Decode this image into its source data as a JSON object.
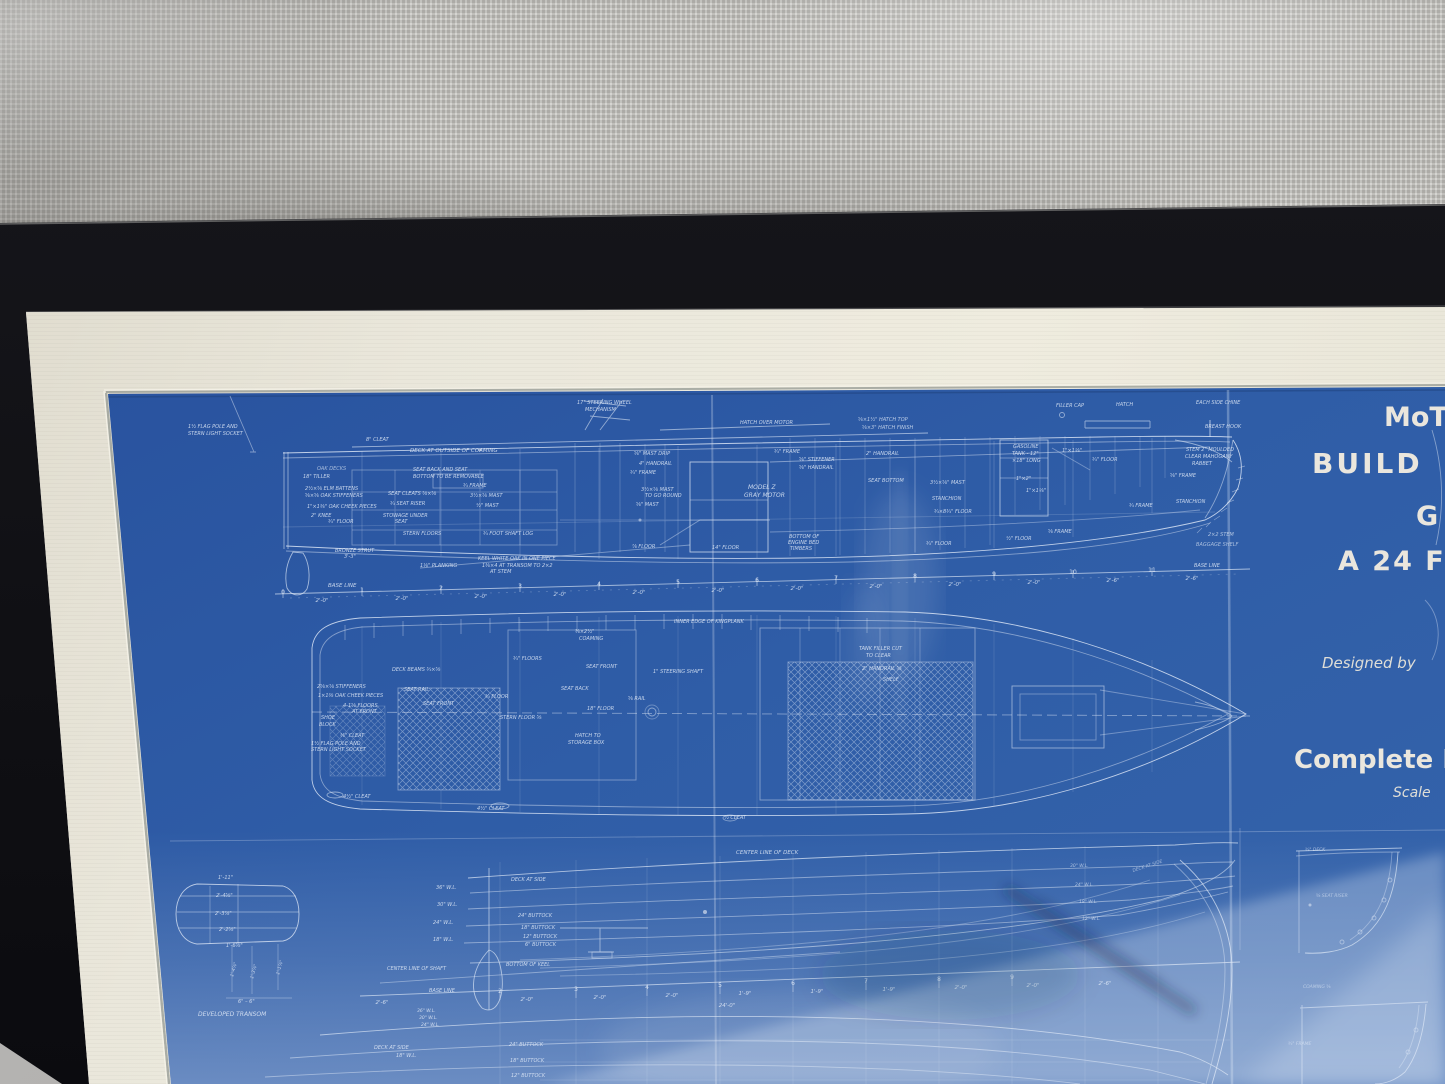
{
  "scene": {
    "description": "Photograph of a framed vintage motor-boat blueprint (white lines on blue paper) in a black frame with cream mat, hung against gray woven fabric; glass reflections across lower half",
    "views": [
      "profile construction elevation",
      "deck plan",
      "lines drawing with developed transom and sections"
    ]
  },
  "colors": {
    "fabric_gray": "#c7c6c2",
    "frame_black": "#141419",
    "mat_cream": "#eae7db",
    "wall_gray": "#b3b2b0",
    "blueprint_blue": "#2f5da6",
    "blueprint_blue_dark": "#27509a",
    "line_ink": "#d9e4f4",
    "title_ink": "#f0ebdf",
    "reflection_tint": "#dde6f5",
    "shadow_tint": "#1a2746"
  },
  "annotations": [
    {
      "n": "title-line-1",
      "t": "MoT",
      "x": 1384,
      "y": 426,
      "s": 27,
      "w": 1,
      "u": 1,
      "c": "#f0ebdf",
      "o": 0.97
    },
    {
      "n": "title-line-2",
      "t": "BUILD",
      "x": 1312,
      "y": 473,
      "s": 28,
      "w": 1,
      "u": 1,
      "c": "#f0ebdf",
      "o": 0.97,
      "ls": 3
    },
    {
      "n": "title-line-3",
      "t": "G",
      "x": 1416,
      "y": 525,
      "s": 27,
      "w": 1,
      "u": 1,
      "c": "#f0ebdf",
      "o": 0.97
    },
    {
      "n": "title-line-4",
      "t": "A 24 F",
      "x": 1338,
      "y": 570,
      "s": 27,
      "w": 1,
      "u": 1,
      "c": "#f0ebdf",
      "o": 0.97,
      "ls": 2
    },
    {
      "n": "designed-by",
      "t": "Designed  by",
      "x": 1322,
      "y": 668,
      "s": 15,
      "c": "#e9e5da",
      "o": 0.95
    },
    {
      "n": "complete-label",
      "t": "Complete H",
      "x": 1294,
      "y": 768,
      "s": 26,
      "w": 1,
      "u": 1,
      "c": "#f0ebdf",
      "o": 0.97
    },
    {
      "n": "scale-label",
      "t": "Scale",
      "x": 1393,
      "y": 797,
      "s": 14,
      "c": "#e9e5da",
      "o": 0.95
    },
    {
      "t": "8\" CLEAT",
      "x": 366,
      "y": 441
    },
    {
      "t": "DECK AT OUTSIDE OF COAMING",
      "x": 410,
      "y": 452,
      "s": 5.5
    },
    {
      "t": "SEAT BACK AND SEAT",
      "x": 413,
      "y": 471
    },
    {
      "t": "BOTTOM TO BE REMOVABLE",
      "x": 413,
      "y": 478
    },
    {
      "t": "17\" STEERING WHEEL",
      "x": 577,
      "y": 404
    },
    {
      "t": "MECHANISM",
      "x": 585,
      "y": 411
    },
    {
      "t": "1½ FLAG POLE AND",
      "x": 188,
      "y": 428
    },
    {
      "t": "STERN LIGHT SOCKET",
      "x": 188,
      "y": 435
    },
    {
      "t": "OAK DECKS",
      "x": 317,
      "y": 470,
      "o": 0.7
    },
    {
      "t": "18\" TILLER",
      "x": 303,
      "y": 478
    },
    {
      "t": "2½×⅝ ELM BATTENS",
      "x": 305,
      "y": 490
    },
    {
      "t": "⅝×⅝ OAK STIFFENERS",
      "x": 305,
      "y": 497
    },
    {
      "t": "1\"×1⅜\" OAK CHEEK PIECES",
      "x": 307,
      "y": 508
    },
    {
      "t": "2\" KNEE",
      "x": 311,
      "y": 517
    },
    {
      "t": "¾\" FLOOR",
      "x": 328,
      "y": 523
    },
    {
      "t": "BRONZE STRUT",
      "x": 335,
      "y": 552
    },
    {
      "t": "3'-3\"",
      "x": 344,
      "y": 558
    },
    {
      "t": "SEAT CLEATS ⅝×⅝",
      "x": 388,
      "y": 495
    },
    {
      "t": "¾ SEAT RISER",
      "x": 390,
      "y": 505
    },
    {
      "t": "STOWAGE UNDER",
      "x": 383,
      "y": 517
    },
    {
      "t": "SEAT",
      "x": 395,
      "y": 523
    },
    {
      "t": "¾ FRAME",
      "x": 463,
      "y": 487
    },
    {
      "t": "3½×⅝ MAST",
      "x": 470,
      "y": 497
    },
    {
      "t": "½\" MAST",
      "x": 476,
      "y": 507
    },
    {
      "t": "STERN FLOORS",
      "x": 403,
      "y": 535
    },
    {
      "t": "¾ FOOT SHAFT LOG",
      "x": 483,
      "y": 535
    },
    {
      "t": "1⅛\" PLANKING",
      "x": 420,
      "y": 567
    },
    {
      "t": "KEEL WHITE OAK IN ONE PIECE",
      "x": 478,
      "y": 560
    },
    {
      "t": "1⅜×4 AT TRANSOM TO 2×2",
      "x": 482,
      "y": 567
    },
    {
      "t": "AT STEM",
      "x": 490,
      "y": 573
    },
    {
      "t": "BASE LINE",
      "x": 328,
      "y": 587,
      "s": 5.5
    },
    {
      "t": "⅝\" MAST DRIP",
      "x": 634,
      "y": 455
    },
    {
      "t": "4\" HANDRAIL",
      "x": 639,
      "y": 465
    },
    {
      "t": "¾\" FRAME",
      "x": 630,
      "y": 474
    },
    {
      "t": "3½×⅝ MAST",
      "x": 641,
      "y": 491
    },
    {
      "t": "TO GO ROUND",
      "x": 645,
      "y": 497
    },
    {
      "t": "⅝\" MAST",
      "x": 636,
      "y": 506
    },
    {
      "t": "MODEL Z",
      "x": 748,
      "y": 489,
      "s": 6
    },
    {
      "t": "GRAY MOTOR",
      "x": 744,
      "y": 497,
      "s": 6
    },
    {
      "t": "HATCH OVER MOTOR",
      "x": 740,
      "y": 424
    },
    {
      "t": "⅝×1½\" HATCH TOP",
      "x": 858,
      "y": 421,
      "o": 0.8
    },
    {
      "t": "⅝×3\" HATCH FINISH",
      "x": 862,
      "y": 429,
      "o": 0.8
    },
    {
      "t": "¾\" FRAME",
      "x": 774,
      "y": 453
    },
    {
      "t": "⅝\" STIFFENER",
      "x": 799,
      "y": 461
    },
    {
      "t": "⅝\" HANDRAIL",
      "x": 799,
      "y": 469
    },
    {
      "t": "2\" HANDRAIL",
      "x": 866,
      "y": 455
    },
    {
      "t": "BOTTOM OF",
      "x": 789,
      "y": 538
    },
    {
      "t": "ENGINE BED",
      "x": 788,
      "y": 544
    },
    {
      "t": "TIMBERS",
      "x": 790,
      "y": 550
    },
    {
      "t": "⅞ FLOOR",
      "x": 632,
      "y": 548
    },
    {
      "t": "14\" FLOOR",
      "x": 712,
      "y": 549
    },
    {
      "t": "SEAT BOTTOM",
      "x": 868,
      "y": 482
    },
    {
      "t": "3½×⅝\" MAST",
      "x": 930,
      "y": 484
    },
    {
      "t": "STANCHION",
      "x": 932,
      "y": 500
    },
    {
      "t": "¾×8¾\" FLOOR",
      "x": 934,
      "y": 513
    },
    {
      "t": "¾\" FLOOR",
      "x": 926,
      "y": 545
    },
    {
      "t": "½\" FLOOR",
      "x": 1006,
      "y": 540
    },
    {
      "t": "⅝ FRAME",
      "x": 1048,
      "y": 533
    },
    {
      "t": "GASOLINE",
      "x": 1013,
      "y": 448
    },
    {
      "t": "TANK - 12\"",
      "x": 1012,
      "y": 455
    },
    {
      "t": "×18\" LONG",
      "x": 1012,
      "y": 462
    },
    {
      "t": "1\"×1⅛\"",
      "x": 1062,
      "y": 452
    },
    {
      "t": "1\"×2\"",
      "x": 1016,
      "y": 480
    },
    {
      "t": "1\"×1⅛\"",
      "x": 1026,
      "y": 492
    },
    {
      "t": "¾\" FLOOR",
      "x": 1092,
      "y": 461
    },
    {
      "t": "⅝\" FRAME",
      "x": 1170,
      "y": 477
    },
    {
      "t": "¾ FRAME",
      "x": 1129,
      "y": 507
    },
    {
      "t": "FILLER CAP",
      "x": 1056,
      "y": 407
    },
    {
      "t": "HATCH",
      "x": 1116,
      "y": 406
    },
    {
      "t": "EACH SIDE CHINE",
      "x": 1196,
      "y": 404
    },
    {
      "t": "BREAST HOOK",
      "x": 1205,
      "y": 428
    },
    {
      "t": "STEM 2\" MOULDED",
      "x": 1186,
      "y": 451
    },
    {
      "t": "CLEAR MAHOGANY",
      "x": 1185,
      "y": 458
    },
    {
      "t": "RABBET",
      "x": 1192,
      "y": 465
    },
    {
      "t": "STANCHION",
      "x": 1176,
      "y": 503
    },
    {
      "t": "2×2 STEM",
      "x": 1208,
      "y": 536,
      "o": 0.75
    },
    {
      "t": "BAGGAGE SHELF",
      "x": 1196,
      "y": 546,
      "o": 0.7
    },
    {
      "t": "BASE LINE",
      "x": 1194,
      "y": 567
    },
    {
      "t": "0",
      "x": 283,
      "y": 594,
      "s": 6,
      "a": 1,
      "u": 1
    },
    {
      "t": "1",
      "x": 362,
      "y": 592,
      "s": 6,
      "a": 1,
      "u": 1
    },
    {
      "t": "2",
      "x": 441,
      "y": 590,
      "s": 6,
      "a": 1,
      "u": 1
    },
    {
      "t": "3",
      "x": 520,
      "y": 588,
      "s": 6,
      "a": 1,
      "u": 1
    },
    {
      "t": "4",
      "x": 599,
      "y": 586,
      "s": 6,
      "a": 1,
      "u": 1
    },
    {
      "t": "5",
      "x": 678,
      "y": 584,
      "s": 6,
      "a": 1,
      "u": 1
    },
    {
      "t": "6",
      "x": 757,
      "y": 582,
      "s": 6,
      "a": 1,
      "u": 1
    },
    {
      "t": "7",
      "x": 836,
      "y": 580,
      "s": 6,
      "a": 1,
      "u": 1
    },
    {
      "t": "8",
      "x": 915,
      "y": 578,
      "s": 6,
      "a": 1,
      "u": 1
    },
    {
      "t": "9",
      "x": 994,
      "y": 576,
      "s": 6,
      "a": 1,
      "u": 1
    },
    {
      "t": "10",
      "x": 1073,
      "y": 574,
      "s": 6,
      "a": 1,
      "u": 1
    },
    {
      "t": "11",
      "x": 1152,
      "y": 572,
      "s": 6,
      "a": 1,
      "u": 1
    },
    {
      "t": "2'-0\"",
      "x": 322,
      "y": 602,
      "s": 5.5,
      "a": 1
    },
    {
      "t": "2'-0\"",
      "x": 402,
      "y": 600,
      "s": 5.5,
      "a": 1
    },
    {
      "t": "2'-0\"",
      "x": 481,
      "y": 598,
      "s": 5.5,
      "a": 1
    },
    {
      "t": "2'-0\"",
      "x": 560,
      "y": 596,
      "s": 5.5,
      "a": 1
    },
    {
      "t": "2'-0\"",
      "x": 639,
      "y": 594,
      "s": 5.5,
      "a": 1
    },
    {
      "t": "2'-0\"",
      "x": 718,
      "y": 592,
      "s": 5.5,
      "a": 1
    },
    {
      "t": "2'-0\"",
      "x": 797,
      "y": 590,
      "s": 5.5,
      "a": 1
    },
    {
      "t": "2'-0\"",
      "x": 876,
      "y": 588,
      "s": 5.5,
      "a": 1
    },
    {
      "t": "2'-0\"",
      "x": 955,
      "y": 586,
      "s": 5.5,
      "a": 1
    },
    {
      "t": "2'-0\"",
      "x": 1034,
      "y": 584,
      "s": 5.5,
      "a": 1
    },
    {
      "t": "2'-6\"",
      "x": 1113,
      "y": 582,
      "s": 5.5,
      "a": 1
    },
    {
      "t": "2'-6\"",
      "x": 1192,
      "y": 580,
      "s": 5.5,
      "a": 1
    },
    {
      "t": "⅜×2½\"",
      "x": 575,
      "y": 633
    },
    {
      "t": "COAMING",
      "x": 579,
      "y": 640
    },
    {
      "t": "¾\" FLOORS",
      "x": 513,
      "y": 660
    },
    {
      "t": "DECK BEAMS ¾×⅝",
      "x": 392,
      "y": 671
    },
    {
      "t": "SEAT RAIL",
      "x": 404,
      "y": 691
    },
    {
      "t": "SEAT FRONT",
      "x": 423,
      "y": 705
    },
    {
      "t": "2⅝×⅝ STIFFENERS",
      "x": 317,
      "y": 688
    },
    {
      "t": "1×1⅜ OAK CHEEK PIECES",
      "x": 318,
      "y": 697
    },
    {
      "t": "4-1⅝ FLOORS",
      "x": 343,
      "y": 707
    },
    {
      "t": "AT FRONT",
      "x": 352,
      "y": 713
    },
    {
      "t": "SHOE",
      "x": 321,
      "y": 719
    },
    {
      "t": "BLOCK",
      "x": 319,
      "y": 726
    },
    {
      "t": "⅜\" CLEAT",
      "x": 340,
      "y": 737
    },
    {
      "t": "1½ FLAG POLE AND",
      "x": 311,
      "y": 745
    },
    {
      "t": "STERN LIGHT SOCKET",
      "x": 311,
      "y": 751
    },
    {
      "t": "¾ FLOOR",
      "x": 485,
      "y": 698
    },
    {
      "t": "STERN FLOOR ⅝",
      "x": 500,
      "y": 719
    },
    {
      "t": "SEAT FRONT",
      "x": 586,
      "y": 668
    },
    {
      "t": "SEAT BACK",
      "x": 561,
      "y": 690
    },
    {
      "t": "18\" FLOOR",
      "x": 587,
      "y": 710
    },
    {
      "t": "HATCH TO",
      "x": 575,
      "y": 737
    },
    {
      "t": "STORAGE BOX",
      "x": 568,
      "y": 744
    },
    {
      "t": "⅝ RAIL",
      "x": 628,
      "y": 700
    },
    {
      "t": "1\" STEERING SHAFT",
      "x": 653,
      "y": 673
    },
    {
      "t": "INNER EDGE OF KINGPLANK",
      "x": 674,
      "y": 623
    },
    {
      "t": "TANK FILLER CUT",
      "x": 859,
      "y": 650
    },
    {
      "t": "TO CLEAR",
      "x": 866,
      "y": 657
    },
    {
      "t": "2\" HANDRAIL ⅝",
      "x": 862,
      "y": 670
    },
    {
      "t": "SHELF",
      "x": 883,
      "y": 681
    },
    {
      "t": "4½\" CLEAT",
      "x": 343,
      "y": 798
    },
    {
      "t": "4½\" CLEAT",
      "x": 477,
      "y": 810
    },
    {
      "t": "½ CLEAT",
      "x": 724,
      "y": 819
    },
    {
      "t": "CENTER LINE OF DECK",
      "x": 736,
      "y": 854,
      "s": 5.5
    },
    {
      "t": "1'-11\"",
      "x": 218,
      "y": 879
    },
    {
      "t": "2'-4⅝\"",
      "x": 216,
      "y": 897
    },
    {
      "t": "2'-3⅞\"",
      "x": 215,
      "y": 915
    },
    {
      "t": "2'-2⅝\"",
      "x": 219,
      "y": 931
    },
    {
      "t": "1'-6⅝\"",
      "x": 226,
      "y": 947
    },
    {
      "t": "1'-4⅞\"",
      "x": 233,
      "y": 977,
      "r": -75,
      "s": 4.5
    },
    {
      "t": "1'-3⅞\"",
      "x": 253,
      "y": 979,
      "r": -75,
      "s": 4.5
    },
    {
      "t": "1'-1⅞\"",
      "x": 279,
      "y": 975,
      "r": -75,
      "s": 4.5
    },
    {
      "t": "6\" – 6\"",
      "x": 238,
      "y": 1003
    },
    {
      "t": "DEVELOPED TRANSOM",
      "x": 198,
      "y": 1016,
      "s": 6
    },
    {
      "t": "DECK AT SIDE",
      "x": 511,
      "y": 881
    },
    {
      "t": "36\" W.L.",
      "x": 436,
      "y": 889
    },
    {
      "t": "30\" W.L.",
      "x": 437,
      "y": 906
    },
    {
      "t": "24\" W.L.",
      "x": 433,
      "y": 924
    },
    {
      "t": "18\" W.L.",
      "x": 433,
      "y": 941
    },
    {
      "t": "24\" BUTTOCK",
      "x": 518,
      "y": 917
    },
    {
      "t": "18\" BUTTOCK",
      "x": 521,
      "y": 929
    },
    {
      "t": "12\" BUTTOCK",
      "x": 523,
      "y": 938
    },
    {
      "t": "6\" BUTTOCK",
      "x": 525,
      "y": 946
    },
    {
      "t": "BOTTOM OF KEEL",
      "x": 506,
      "y": 966
    },
    {
      "t": "CENTER LINE OF SHAFT",
      "x": 387,
      "y": 970
    },
    {
      "t": "BASE LINE",
      "x": 429,
      "y": 992
    },
    {
      "t": "2",
      "x": 500,
      "y": 993,
      "s": 6,
      "a": 1,
      "u": 1
    },
    {
      "t": "3",
      "x": 576,
      "y": 991,
      "s": 6,
      "a": 1,
      "u": 1
    },
    {
      "t": "4",
      "x": 647,
      "y": 989,
      "s": 6,
      "a": 1,
      "u": 1
    },
    {
      "t": "5",
      "x": 720,
      "y": 987,
      "s": 6,
      "a": 1,
      "u": 1
    },
    {
      "t": "6",
      "x": 793,
      "y": 985,
      "s": 6,
      "a": 1,
      "u": 1
    },
    {
      "t": "7",
      "x": 866,
      "y": 983,
      "s": 6,
      "a": 1,
      "u": 1
    },
    {
      "t": "8",
      "x": 939,
      "y": 981,
      "s": 6,
      "a": 1,
      "u": 1
    },
    {
      "t": "9",
      "x": 1012,
      "y": 979,
      "s": 6,
      "a": 1,
      "u": 1
    },
    {
      "t": "2'-6\"",
      "x": 382,
      "y": 1004,
      "s": 5.5,
      "a": 1
    },
    {
      "t": "2'-0\"",
      "x": 527,
      "y": 1001,
      "s": 5.5,
      "a": 1
    },
    {
      "t": "2'-0\"",
      "x": 600,
      "y": 999,
      "s": 5.5,
      "a": 1
    },
    {
      "t": "2'-0\"",
      "x": 672,
      "y": 997,
      "s": 5.5,
      "a": 1
    },
    {
      "t": "1'-9\"",
      "x": 745,
      "y": 995,
      "s": 5.5,
      "a": 1
    },
    {
      "t": "1'-9\"",
      "x": 817,
      "y": 993,
      "s": 5.5,
      "a": 1
    },
    {
      "t": "1'-9\"",
      "x": 889,
      "y": 991,
      "s": 5.5,
      "a": 1
    },
    {
      "t": "2'-0\"",
      "x": 961,
      "y": 989,
      "s": 5.5,
      "a": 1
    },
    {
      "t": "2'-0\"",
      "x": 1033,
      "y": 987,
      "s": 5.5,
      "a": 1
    },
    {
      "t": "2'-6\"",
      "x": 1105,
      "y": 985,
      "s": 5.5,
      "a": 1
    },
    {
      "t": "24'-0\"",
      "x": 727,
      "y": 1007,
      "s": 5.5,
      "a": 1
    },
    {
      "t": "36\" W.L.",
      "x": 417,
      "y": 1012,
      "s": 4.5
    },
    {
      "t": "30\" W.L.",
      "x": 419,
      "y": 1019,
      "s": 4.5
    },
    {
      "t": "24\" W.L.",
      "x": 421,
      "y": 1026,
      "s": 4.5
    },
    {
      "t": "DECK AT SIDE",
      "x": 374,
      "y": 1049
    },
    {
      "t": "18\" W.L.",
      "x": 396,
      "y": 1057
    },
    {
      "t": "24\" BUTTOCK",
      "x": 509,
      "y": 1046
    },
    {
      "t": "18\" BUTTOCK",
      "x": 510,
      "y": 1062
    },
    {
      "t": "12\" BUTTOCK",
      "x": 511,
      "y": 1077
    },
    {
      "t": "30\" W.L.",
      "x": 1070,
      "y": 867,
      "o": 0.7,
      "s": 4.5
    },
    {
      "t": "24\" W.L.",
      "x": 1075,
      "y": 886,
      "o": 0.7,
      "s": 4.5
    },
    {
      "t": "18\" W.L.",
      "x": 1079,
      "y": 903,
      "o": 0.7,
      "s": 4.5
    },
    {
      "t": "12\" W.L.",
      "x": 1082,
      "y": 920,
      "o": 0.7,
      "s": 4.5
    },
    {
      "t": "DECK AT SIDE",
      "x": 1133,
      "y": 872,
      "r": -18,
      "o": 0.6,
      "s": 4.5
    },
    {
      "t": "¾\" DECK",
      "x": 1305,
      "y": 851,
      "o": 0.7,
      "s": 4.5
    },
    {
      "t": "⅝ SEAT RISER",
      "x": 1316,
      "y": 897,
      "o": 0.6,
      "s": 4.5
    },
    {
      "t": "COAMING ⅝",
      "x": 1303,
      "y": 988,
      "o": 0.6,
      "s": 4.5
    },
    {
      "t": "¾\" FRAME",
      "x": 1288,
      "y": 1045,
      "o": 0.6,
      "s": 4.5
    }
  ]
}
